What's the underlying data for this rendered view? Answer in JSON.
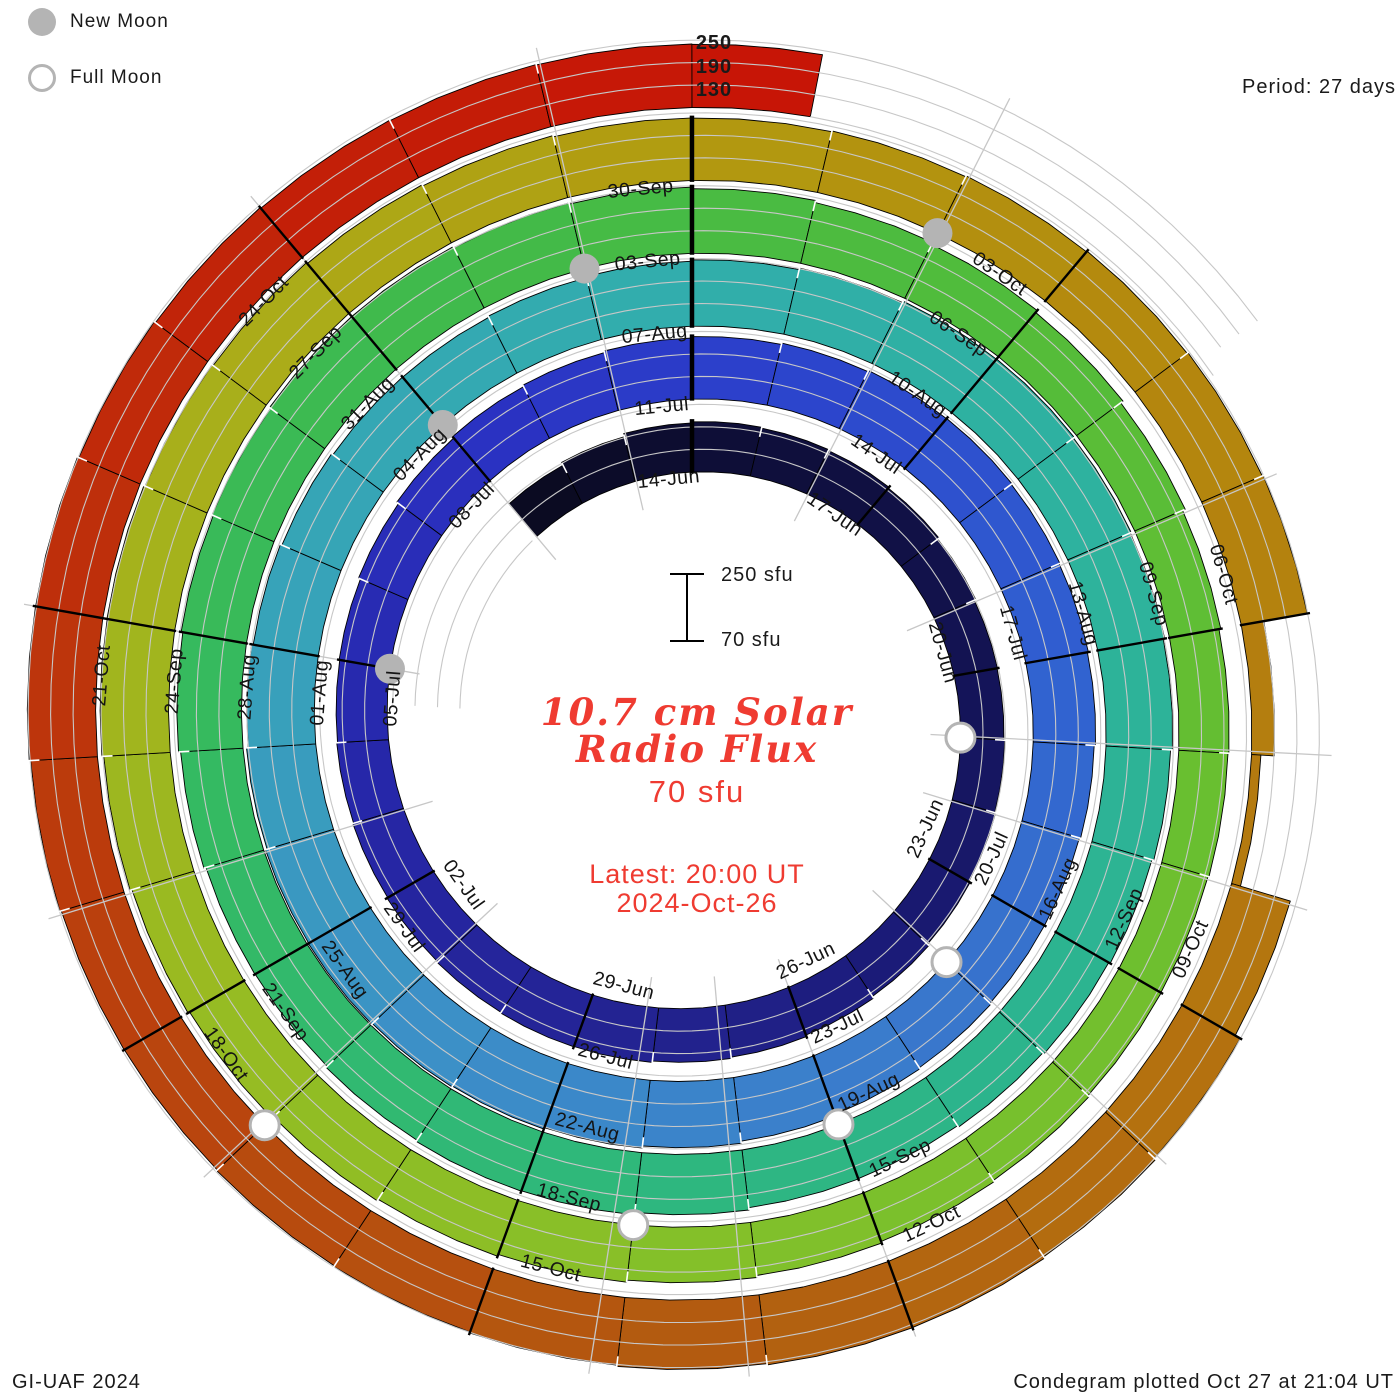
{
  "legend": {
    "new_moon": "New Moon",
    "full_moon": "Full Moon"
  },
  "period_label": "Period: 27 days",
  "radial_scale_labels": [
    "250",
    "190",
    "130"
  ],
  "scale_bar": {
    "top": "250 sfu",
    "bottom": "70 sfu"
  },
  "center": {
    "title_line1": "10.7 cm Solar",
    "title_line2": "Radio Flux",
    "current_value": "70 sfu",
    "latest_line1": "Latest: 20:00 UT",
    "latest_line2": "2024-Oct-26",
    "accent_color": "#ef3b31"
  },
  "footer": {
    "left": "GI-UAF 2024",
    "right": "Condegram plotted Oct 27 at 21:04 UT"
  },
  "colors": {
    "band_outline": "#000000",
    "gridline": "#c7c7c7",
    "moon_gray": "#b4b4b4",
    "label_color": "#141414",
    "background": "#ffffff"
  },
  "chart_data": {
    "type": "spiral",
    "title": "10.7 cm Solar Radio Flux Condegram",
    "period_days": 27,
    "start_date": "2024-06-11",
    "end_date": "2024-10-26 20:00 UT",
    "baseline_sfu": 70,
    "gridline_sfu": [
      130,
      190,
      250
    ],
    "date_labels": [
      [
        "14-Jun",
        0,
        205
      ],
      [
        "17-Jun",
        3,
        198
      ],
      [
        "20-Jun",
        6,
        185
      ],
      [
        "23-Jun",
        9,
        192
      ],
      [
        "26-Jun",
        12,
        208
      ],
      [
        "29-Jun",
        15,
        218
      ],
      [
        "02-Jul",
        18,
        212
      ],
      [
        "05-Jul",
        21,
        205
      ],
      [
        "08-Jul",
        24,
        222
      ],
      [
        "11-Jul",
        27,
        235
      ],
      [
        "14-Jul",
        30,
        245
      ],
      [
        "17-Jul",
        33,
        238
      ],
      [
        "20-Jul",
        36,
        228
      ],
      [
        "23-Jul",
        39,
        238
      ],
      [
        "26-Jul",
        42,
        255
      ],
      [
        "29-Jul",
        45,
        262
      ],
      [
        "01-Aug",
        48,
        248
      ],
      [
        "04-Aug",
        51,
        235
      ],
      [
        "07-Aug",
        54,
        245
      ],
      [
        "10-Aug",
        57,
        258
      ],
      [
        "13-Aug",
        60,
        250
      ],
      [
        "16-Aug",
        63,
        235
      ],
      [
        "19-Aug",
        66,
        222
      ],
      [
        "22-Aug",
        69,
        240
      ],
      [
        "25-Aug",
        72,
        228
      ],
      [
        "28-Aug",
        75,
        245
      ],
      [
        "31-Aug",
        78,
        255
      ],
      [
        "03-Sep",
        81,
        245
      ],
      [
        "06-Sep",
        84,
        228
      ],
      [
        "09-Sep",
        87,
        205
      ],
      [
        "12-Sep",
        90,
        198
      ],
      [
        "15-Sep",
        93,
        210
      ],
      [
        "18-Sep",
        96,
        226
      ],
      [
        "21-Sep",
        99,
        240
      ],
      [
        "24-Sep",
        102,
        255
      ],
      [
        "27-Sep",
        105,
        245
      ],
      [
        "30-Sep",
        108,
        235
      ],
      [
        "03-Oct",
        111,
        242
      ],
      [
        "06-Oct",
        114,
        250
      ],
      [
        "09-Oct",
        117,
        247
      ],
      [
        "12-Oct",
        120,
        260
      ],
      [
        "15-Oct",
        123,
        250
      ],
      [
        "18-Oct",
        126,
        243
      ],
      [
        "21-Oct",
        129,
        254
      ],
      [
        "24-Oct",
        132,
        242
      ]
    ],
    "extra_flux_knots": [
      [
        -3,
        180
      ],
      [
        114.65,
        95
      ],
      [
        115.9,
        95
      ],
      [
        116.55,
        245
      ],
      [
        135.83,
        238
      ]
    ],
    "colormap": [
      [
        -3,
        "#0a0a1e"
      ],
      [
        0,
        "#0d0d34"
      ],
      [
        5,
        "#12124e"
      ],
      [
        10,
        "#1a1a74"
      ],
      [
        14,
        "#232390"
      ],
      [
        19,
        "#2626a6"
      ],
      [
        24,
        "#2a30c0"
      ],
      [
        28,
        "#2c42cc"
      ],
      [
        33,
        "#3060d0"
      ],
      [
        38,
        "#3a7acc"
      ],
      [
        43,
        "#3c8ec8"
      ],
      [
        48,
        "#38a2ba"
      ],
      [
        53,
        "#32acae"
      ],
      [
        58,
        "#2eb2a0"
      ],
      [
        64,
        "#2cb48e"
      ],
      [
        69,
        "#2fb878"
      ],
      [
        74,
        "#35ba60"
      ],
      [
        79,
        "#41ba4a"
      ],
      [
        84,
        "#52bc3a"
      ],
      [
        89,
        "#6cbf2f"
      ],
      [
        94,
        "#82c02a"
      ],
      [
        99,
        "#98bb22"
      ],
      [
        104,
        "#aaae1a"
      ],
      [
        108,
        "#b29a10"
      ],
      [
        112,
        "#b4880e"
      ],
      [
        117,
        "#b4740f"
      ],
      [
        121,
        "#b25e10"
      ],
      [
        125,
        "#b8480e"
      ],
      [
        128,
        "#bc380c"
      ],
      [
        132,
        "#c22108"
      ],
      [
        136,
        "#c81306"
      ]
    ],
    "moons": {
      "new": [
        [
          "05-Jul",
          21
        ],
        [
          "04-Aug",
          51
        ],
        [
          "02-Sep",
          80
        ],
        [
          "02-Oct",
          110
        ]
      ],
      "full": [
        [
          "21-Jun",
          7
        ],
        [
          "21-Jul",
          37
        ],
        [
          "19-Aug",
          66
        ],
        [
          "17-Sep",
          95
        ],
        [
          "17-Oct",
          125
        ]
      ]
    },
    "phase_line_angles_deg": [
      27,
      67,
      93,
      107,
      133,
      160,
      175,
      189,
      227,
      253,
      280,
      320,
      347
    ],
    "geometry": {
      "cx": 692,
      "cy": 722,
      "r0": 250,
      "dr_px_per_day": 2.7,
      "px_per_sfu": 0.375,
      "deg_per_day": 13.3333,
      "t_start": -3,
      "t_end": 135.83
    }
  }
}
